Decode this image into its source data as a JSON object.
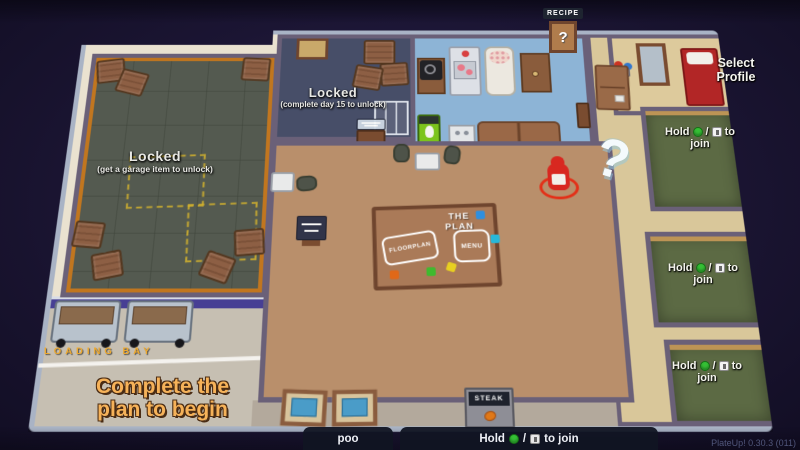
{
  "hud": {
    "recipe_label": "RECIPE",
    "recipe_question": "?",
    "select_profile_label": "Select Profile",
    "loading_bay_label": "LOADING BAY",
    "complete_plan_line1": "Complete the",
    "complete_plan_line2": "plan to begin",
    "big_question_mark": "?",
    "version_text": "PlateUp! 0.30.3 (011)",
    "player_name": "poo"
  },
  "join_prompt": {
    "hold": "Hold",
    "slash": "/",
    "to": "to",
    "join": "join",
    "to_join": "to join"
  },
  "locked_rooms": {
    "garage": {
      "title": "Locked",
      "subtitle": "(get a garage item to unlock)"
    },
    "storage": {
      "title": "Locked",
      "subtitle": "(complete day 15 to unlock)"
    }
  },
  "plan_table": {
    "title": "THE PLAN",
    "floorplan_button": "FLOORPLAN",
    "menu_button": "MENU"
  },
  "signs": {
    "steak": "STEAK"
  },
  "colors": {
    "accent_orange": "#f6b259",
    "join_green": "#35c035",
    "chef_red": "#d82820",
    "bed_red": "#b22626"
  }
}
